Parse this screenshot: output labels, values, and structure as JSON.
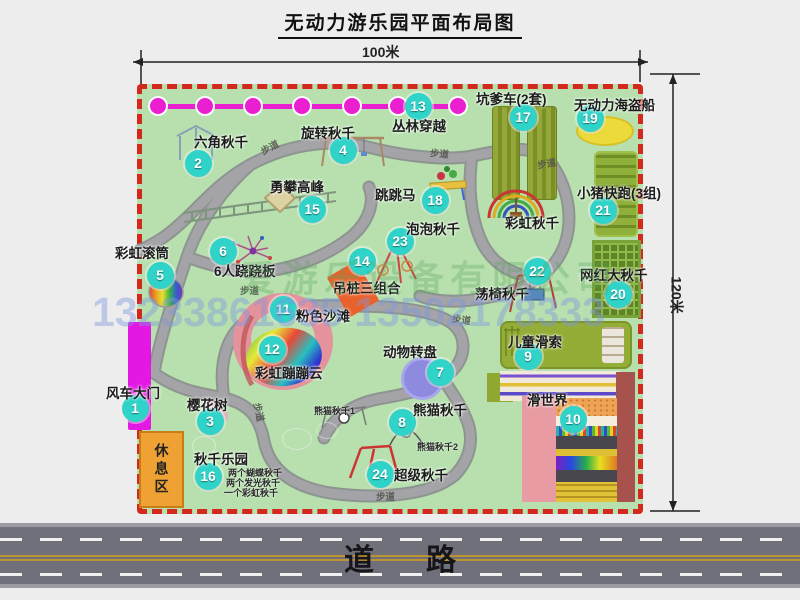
{
  "title": "无动力游乐园平面布局图",
  "dimensions": {
    "top": "100米",
    "right": "120米"
  },
  "road_label": "道路",
  "watermark": {
    "company": "爱游乐设备有限公司",
    "phones": "13233861635 13502178333"
  },
  "rest_area_label": "休息区",
  "colors": {
    "park_green": "#b7e0ae",
    "border_red": "#d3281c",
    "marker_teal": "#2fd3c8",
    "zipline_magenta": "#ea1fd0",
    "gate_magenta": "#e318e3",
    "rest_orange": "#efa233",
    "road_gray": "#70707a",
    "pirate_yellow": "#ecd93a",
    "carousel_purple": "#8d8adf",
    "beach_pink": "#e4939c"
  },
  "zipline": {
    "dots": [
      158,
      205,
      253,
      302,
      352,
      398,
      458
    ]
  },
  "markers": [
    {
      "n": "1",
      "x": 135,
      "y": 408
    },
    {
      "n": "2",
      "x": 198,
      "y": 163
    },
    {
      "n": "3",
      "x": 210,
      "y": 421
    },
    {
      "n": "4",
      "x": 343,
      "y": 150
    },
    {
      "n": "5",
      "x": 160,
      "y": 275
    },
    {
      "n": "6",
      "x": 223,
      "y": 251
    },
    {
      "n": "7",
      "x": 440,
      "y": 372
    },
    {
      "n": "8",
      "x": 402,
      "y": 422
    },
    {
      "n": "9",
      "x": 528,
      "y": 356
    },
    {
      "n": "10",
      "x": 573,
      "y": 419
    },
    {
      "n": "11",
      "x": 283,
      "y": 309
    },
    {
      "n": "12",
      "x": 272,
      "y": 349
    },
    {
      "n": "13",
      "x": 418,
      "y": 106
    },
    {
      "n": "14",
      "x": 362,
      "y": 261
    },
    {
      "n": "15",
      "x": 312,
      "y": 209
    },
    {
      "n": "16",
      "x": 208,
      "y": 476
    },
    {
      "n": "17",
      "x": 523,
      "y": 117
    },
    {
      "n": "18",
      "x": 435,
      "y": 200
    },
    {
      "n": "19",
      "x": 590,
      "y": 118
    },
    {
      "n": "20",
      "x": 618,
      "y": 294
    },
    {
      "n": "21",
      "x": 603,
      "y": 210
    },
    {
      "n": "22",
      "x": 537,
      "y": 271
    },
    {
      "n": "23",
      "x": 400,
      "y": 241
    },
    {
      "n": "24",
      "x": 380,
      "y": 474
    }
  ],
  "labels_main": [
    {
      "t": "六角秋千",
      "x": 194,
      "y": 131
    },
    {
      "t": "旋转秋千",
      "x": 301,
      "y": 122
    },
    {
      "t": "丛林穿越",
      "x": 392,
      "y": 115
    },
    {
      "t": "坑爹车(2套)",
      "x": 476,
      "y": 88
    },
    {
      "t": "无动力海盗船",
      "x": 574,
      "y": 94
    },
    {
      "t": "勇攀高峰",
      "x": 270,
      "y": 176
    },
    {
      "t": "跳跳马",
      "x": 375,
      "y": 184
    },
    {
      "t": "小猪快跑(3组)",
      "x": 577,
      "y": 182
    },
    {
      "t": "泡泡秋千",
      "x": 406,
      "y": 218
    },
    {
      "t": "彩虹秋千",
      "x": 505,
      "y": 212
    },
    {
      "t": "彩虹滚筒",
      "x": 115,
      "y": 242
    },
    {
      "t": "6人跷跷板",
      "x": 214,
      "y": 260
    },
    {
      "t": "吊桩三组合",
      "x": 333,
      "y": 277
    },
    {
      "t": "荡椅秋千",
      "x": 475,
      "y": 283
    },
    {
      "t": "网红大秋千",
      "x": 580,
      "y": 264
    },
    {
      "t": "粉色沙滩",
      "x": 296,
      "y": 305
    },
    {
      "t": "风车大门",
      "x": 106,
      "y": 382
    },
    {
      "t": "樱花树",
      "x": 187,
      "y": 394
    },
    {
      "t": "彩虹蹦蹦云",
      "x": 255,
      "y": 362
    },
    {
      "t": "动物转盘",
      "x": 383,
      "y": 341
    },
    {
      "t": "熊猫秋千",
      "x": 413,
      "y": 399
    },
    {
      "t": "儿童滑索",
      "x": 508,
      "y": 331
    },
    {
      "t": "滑世界",
      "x": 527,
      "y": 389
    },
    {
      "t": "秋千乐园",
      "x": 194,
      "y": 448
    },
    {
      "t": "超级秋千",
      "x": 394,
      "y": 464
    }
  ],
  "labels_small": [
    {
      "t": "熊猫秋千1",
      "x": 314,
      "y": 404
    },
    {
      "t": "熊猫秋千2",
      "x": 417,
      "y": 440
    },
    {
      "t": "两个蝴蝶秋千",
      "x": 228,
      "y": 466
    },
    {
      "t": "两个发光秋千",
      "x": 226,
      "y": 476
    },
    {
      "t": "一个彩虹秋千",
      "x": 224,
      "y": 486
    }
  ],
  "path_label_text": "步道",
  "labels_path": [
    {
      "x": 260,
      "y": 140,
      "r": -28
    },
    {
      "x": 430,
      "y": 146,
      "r": 5
    },
    {
      "x": 537,
      "y": 156,
      "r": -10
    },
    {
      "x": 240,
      "y": 283,
      "r": 0
    },
    {
      "x": 250,
      "y": 405,
      "r": 78
    },
    {
      "x": 376,
      "y": 489,
      "r": 0
    },
    {
      "x": 452,
      "y": 312,
      "r": 8
    }
  ]
}
